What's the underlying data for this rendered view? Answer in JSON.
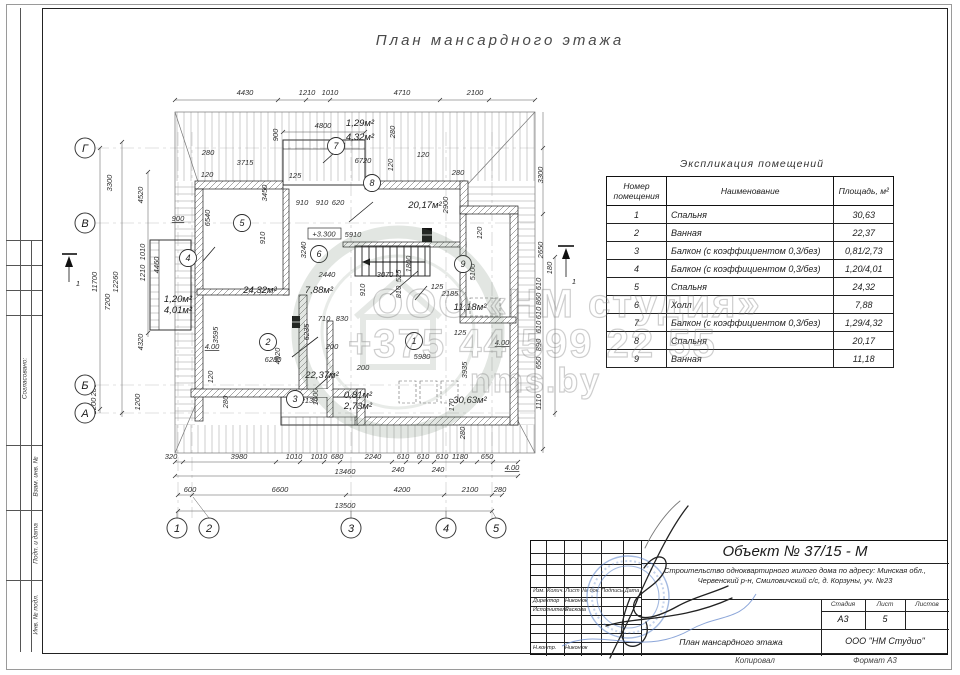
{
  "sheet": {
    "title": "План мансардного этажа"
  },
  "watermark": {
    "line1": "ООО «НМ студия»",
    "line2": "+375 44 599 22 55",
    "line3": "nms.by"
  },
  "sidebar": {
    "agreed": "Согласовано:",
    "subst": "Взам. инв. №",
    "sign_date": "Подп. и дата",
    "inv_no": "Инв. № подл."
  },
  "schedule": {
    "title": "Экспликация помещений",
    "columns": [
      "Номер помещения",
      "Наименование",
      "Площадь, м²"
    ],
    "rows": [
      [
        "1",
        "Спальня",
        "30,63"
      ],
      [
        "2",
        "Ванная",
        "22,37"
      ],
      [
        "3",
        "Балкон (с коэффициентом 0,3/без)",
        "0,81/2,73"
      ],
      [
        "4",
        "Балкон (с коэффициентом 0,3/без)",
        "1,20/4,01"
      ],
      [
        "5",
        "Спальня",
        "24,32"
      ],
      [
        "6",
        "Холл",
        "7,88"
      ],
      [
        "7",
        "Балкон (с коэффициентом 0,3/без)",
        "1,29/4,32"
      ],
      [
        "8",
        "Спальня",
        "20,17"
      ],
      [
        "9",
        "Ванная",
        "11,18"
      ]
    ]
  },
  "plan": {
    "elevation": "+3.300",
    "grid_cols": [
      {
        "l": "1",
        "x": 115
      },
      {
        "l": "2",
        "x": 147
      },
      {
        "l": "3",
        "x": 289
      },
      {
        "l": "4",
        "x": 384
      },
      {
        "l": "5",
        "x": 434
      }
    ],
    "grid_rows": [
      {
        "l": "Г",
        "y": 76
      },
      {
        "l": "В",
        "y": 151
      },
      {
        "l": "Б",
        "y": 313
      },
      {
        "l": "А",
        "y": 341
      }
    ],
    "rooms": [
      {
        "n": "1",
        "x": 352,
        "y": 269
      },
      {
        "n": "2",
        "x": 206,
        "y": 270
      },
      {
        "n": "3",
        "x": 233,
        "y": 327
      },
      {
        "n": "4",
        "x": 126,
        "y": 186
      },
      {
        "n": "5",
        "x": 180,
        "y": 151
      },
      {
        "n": "6",
        "x": 257,
        "y": 182
      },
      {
        "n": "7",
        "x": 274,
        "y": 74
      },
      {
        "n": "8",
        "x": 310,
        "y": 111
      },
      {
        "n": "9",
        "x": 401,
        "y": 192
      }
    ],
    "areas": [
      {
        "t": "24,32м²",
        "x": 198,
        "y": 221
      },
      {
        "t": "7,88м²",
        "x": 257,
        "y": 221
      },
      {
        "t": "22,37м²",
        "x": 260,
        "y": 306
      },
      {
        "t": "30,63м²",
        "x": 408,
        "y": 331
      },
      {
        "t": "11,18м²",
        "x": 408,
        "y": 238
      },
      {
        "t": "20,17м²",
        "x": 363,
        "y": 136
      },
      {
        "t": "1,29м²",
        "x": 298,
        "y": 54
      },
      {
        "t": "4,32м²",
        "x": 298,
        "y": 68
      },
      {
        "t": "1,20м²",
        "x": 116,
        "y": 230
      },
      {
        "t": "4,01м²",
        "x": 116,
        "y": 241
      },
      {
        "t": "0,81м²",
        "x": 296,
        "y": 326
      },
      {
        "t": "2,73м²",
        "x": 296,
        "y": 337
      }
    ],
    "dims": [
      {
        "t": "4430",
        "x": 183,
        "y": 23
      },
      {
        "t": "1210",
        "x": 245,
        "y": 23
      },
      {
        "t": "1010",
        "x": 268,
        "y": 23
      },
      {
        "t": "4710",
        "x": 340,
        "y": 23
      },
      {
        "t": "2100",
        "x": 413,
        "y": 23
      },
      {
        "t": "4800",
        "x": 261,
        "y": 56
      },
      {
        "t": "900",
        "x": 216,
        "y": 63,
        "r": 1
      },
      {
        "t": "280",
        "x": 333,
        "y": 60,
        "r": 1
      },
      {
        "t": "280",
        "x": 146,
        "y": 83
      },
      {
        "t": "120",
        "x": 145,
        "y": 105
      },
      {
        "t": "3715",
        "x": 183,
        "y": 93
      },
      {
        "t": "6720",
        "x": 301,
        "y": 91
      },
      {
        "t": "120",
        "x": 361,
        "y": 85
      },
      {
        "t": "120",
        "x": 331,
        "y": 93,
        "r": 1
      },
      {
        "t": "280",
        "x": 396,
        "y": 103
      },
      {
        "t": "125",
        "x": 233,
        "y": 106
      },
      {
        "t": "3450",
        "x": 205,
        "y": 121,
        "r": 1
      },
      {
        "t": "2900",
        "x": 386,
        "y": 133,
        "r": 1
      },
      {
        "t": "910",
        "x": 240,
        "y": 133
      },
      {
        "t": "910",
        "x": 260,
        "y": 133
      },
      {
        "t": "620",
        "x": 276,
        "y": 133
      },
      {
        "t": "900",
        "x": 116,
        "y": 149,
        "u": 1
      },
      {
        "t": "6540",
        "x": 148,
        "y": 146,
        "r": 1
      },
      {
        "t": "910",
        "x": 203,
        "y": 166,
        "r": 1
      },
      {
        "t": "4460",
        "x": 97,
        "y": 193,
        "r": 1
      },
      {
        "t": "3300",
        "x": 50,
        "y": 111,
        "r": 1
      },
      {
        "t": "4520",
        "x": 81,
        "y": 123,
        "r": 1
      },
      {
        "t": "11700",
        "x": 35,
        "y": 210,
        "r": 1
      },
      {
        "t": "12260",
        "x": 56,
        "y": 210,
        "r": 1
      },
      {
        "t": "1010",
        "x": 83,
        "y": 180,
        "r": 1
      },
      {
        "t": "1210",
        "x": 83,
        "y": 201,
        "r": 1
      },
      {
        "t": "7200",
        "x": 48,
        "y": 230,
        "r": 1
      },
      {
        "t": "4320",
        "x": 81,
        "y": 270,
        "r": 1
      },
      {
        "t": "280",
        "x": 34,
        "y": 318,
        "r": 1
      },
      {
        "t": "1200",
        "x": 34,
        "y": 334,
        "r": 1
      },
      {
        "t": "1200",
        "x": 78,
        "y": 330,
        "r": 1
      },
      {
        "t": "5910",
        "x": 291,
        "y": 165
      },
      {
        "t": "3240",
        "x": 244,
        "y": 178,
        "r": 1
      },
      {
        "t": "2440",
        "x": 265,
        "y": 205
      },
      {
        "t": "3070",
        "x": 323,
        "y": 205
      },
      {
        "t": "910",
        "x": 303,
        "y": 218,
        "r": 1
      },
      {
        "t": "1800",
        "x": 349,
        "y": 192,
        "r": 1
      },
      {
        "t": "525",
        "x": 339,
        "y": 204,
        "r": 1
      },
      {
        "t": "810",
        "x": 339,
        "y": 220,
        "r": 1
      },
      {
        "t": "120",
        "x": 420,
        "y": 161,
        "r": 1
      },
      {
        "t": "2185",
        "x": 388,
        "y": 224
      },
      {
        "t": "5100",
        "x": 413,
        "y": 200,
        "r": 1
      },
      {
        "t": "125",
        "x": 375,
        "y": 217
      },
      {
        "t": "710",
        "x": 262,
        "y": 249
      },
      {
        "t": "830",
        "x": 280,
        "y": 249
      },
      {
        "t": "6235",
        "x": 247,
        "y": 260,
        "r": 1
      },
      {
        "t": "4920",
        "x": 218,
        "y": 284,
        "r": 1
      },
      {
        "t": "200",
        "x": 270,
        "y": 277
      },
      {
        "t": "200",
        "x": 301,
        "y": 298
      },
      {
        "t": "5980",
        "x": 360,
        "y": 287
      },
      {
        "t": "6280",
        "x": 211,
        "y": 290
      },
      {
        "t": "3595",
        "x": 156,
        "y": 263,
        "r": 1
      },
      {
        "t": "4.00",
        "x": 150,
        "y": 277,
        "u": 1
      },
      {
        "t": "4.00",
        "x": 440,
        "y": 273,
        "u": 1
      },
      {
        "t": "120",
        "x": 151,
        "y": 305,
        "r": 1
      },
      {
        "t": "280",
        "x": 166,
        "y": 330,
        "r": 1
      },
      {
        "t": "2130",
        "x": 247,
        "y": 331
      },
      {
        "t": "1000",
        "x": 256,
        "y": 325,
        "r": 1
      },
      {
        "t": "170",
        "x": 392,
        "y": 333,
        "r": 1
      },
      {
        "t": "3935",
        "x": 405,
        "y": 298,
        "r": 1
      },
      {
        "t": "125",
        "x": 398,
        "y": 263
      },
      {
        "t": "1110",
        "x": 479,
        "y": 330,
        "r": 1
      },
      {
        "t": "280",
        "x": 403,
        "y": 361,
        "r": 1
      },
      {
        "t": "3300",
        "x": 481,
        "y": 103,
        "r": 1
      },
      {
        "t": "2650",
        "x": 481,
        "y": 178,
        "r": 1
      },
      {
        "t": "180",
        "x": 490,
        "y": 196,
        "r": 1
      },
      {
        "t": "610",
        "x": 479,
        "y": 212,
        "r": 1
      },
      {
        "t": "860",
        "x": 479,
        "y": 227,
        "r": 1
      },
      {
        "t": "610",
        "x": 479,
        "y": 241,
        "r": 1
      },
      {
        "t": "610",
        "x": 479,
        "y": 255,
        "r": 1
      },
      {
        "t": "890",
        "x": 479,
        "y": 273,
        "r": 1
      },
      {
        "t": "650",
        "x": 479,
        "y": 291,
        "r": 1
      },
      {
        "t": "320",
        "x": 109,
        "y": 387
      },
      {
        "t": "3980",
        "x": 177,
        "y": 387
      },
      {
        "t": "1010",
        "x": 232,
        "y": 387
      },
      {
        "t": "1010",
        "x": 257,
        "y": 387
      },
      {
        "t": "680",
        "x": 275,
        "y": 387
      },
      {
        "t": "2240",
        "x": 311,
        "y": 387
      },
      {
        "t": "610",
        "x": 341,
        "y": 387
      },
      {
        "t": "610",
        "x": 361,
        "y": 387
      },
      {
        "t": "610",
        "x": 380,
        "y": 387
      },
      {
        "t": "1180",
        "x": 398,
        "y": 387
      },
      {
        "t": "650",
        "x": 425,
        "y": 387
      },
      {
        "t": "240",
        "x": 336,
        "y": 400
      },
      {
        "t": "240",
        "x": 376,
        "y": 400
      },
      {
        "t": "4.00",
        "x": 450,
        "y": 398,
        "u": 1
      },
      {
        "t": "13460",
        "x": 283,
        "y": 402
      },
      {
        "t": "600",
        "x": 128,
        "y": 420
      },
      {
        "t": "6600",
        "x": 218,
        "y": 420
      },
      {
        "t": "4200",
        "x": 340,
        "y": 420
      },
      {
        "t": "2100",
        "x": 408,
        "y": 420
      },
      {
        "t": "280",
        "x": 438,
        "y": 420
      },
      {
        "t": "13500",
        "x": 283,
        "y": 436
      },
      {
        "t": "1",
        "x": 16,
        "y": 214
      },
      {
        "t": "1",
        "x": 512,
        "y": 212
      }
    ]
  },
  "titleblock": {
    "object": "Объект № 37/15 - М",
    "description": "Строительство одноквартирного жилого дома по адресу: Минская обл., Червенский р-н, Смиловичский с/с, д. Корзуны, уч. №23",
    "columns": [
      "Изм.",
      "Колич.",
      "Лист",
      "№ док.",
      "Подпись",
      "Дата"
    ],
    "signers": [
      {
        "role": "Директор",
        "name": "Никонюк",
        "y": 57
      },
      {
        "role": "Исполнитель",
        "name": "Раскова",
        "y": 66
      },
      {
        "role": "Н.контр.",
        "name": "Никонюк",
        "y": 104
      }
    ],
    "stage_label": "Стадия",
    "sheet_label": "Лист",
    "sheets_label": "Листов",
    "stage": "А3",
    "sheet": "5",
    "sheets": "",
    "drawing_name": "План мансардного этажа",
    "company": "ООО \"НМ Студио\""
  },
  "footer": {
    "copied": "Копировал",
    "format": "Формат А3"
  }
}
